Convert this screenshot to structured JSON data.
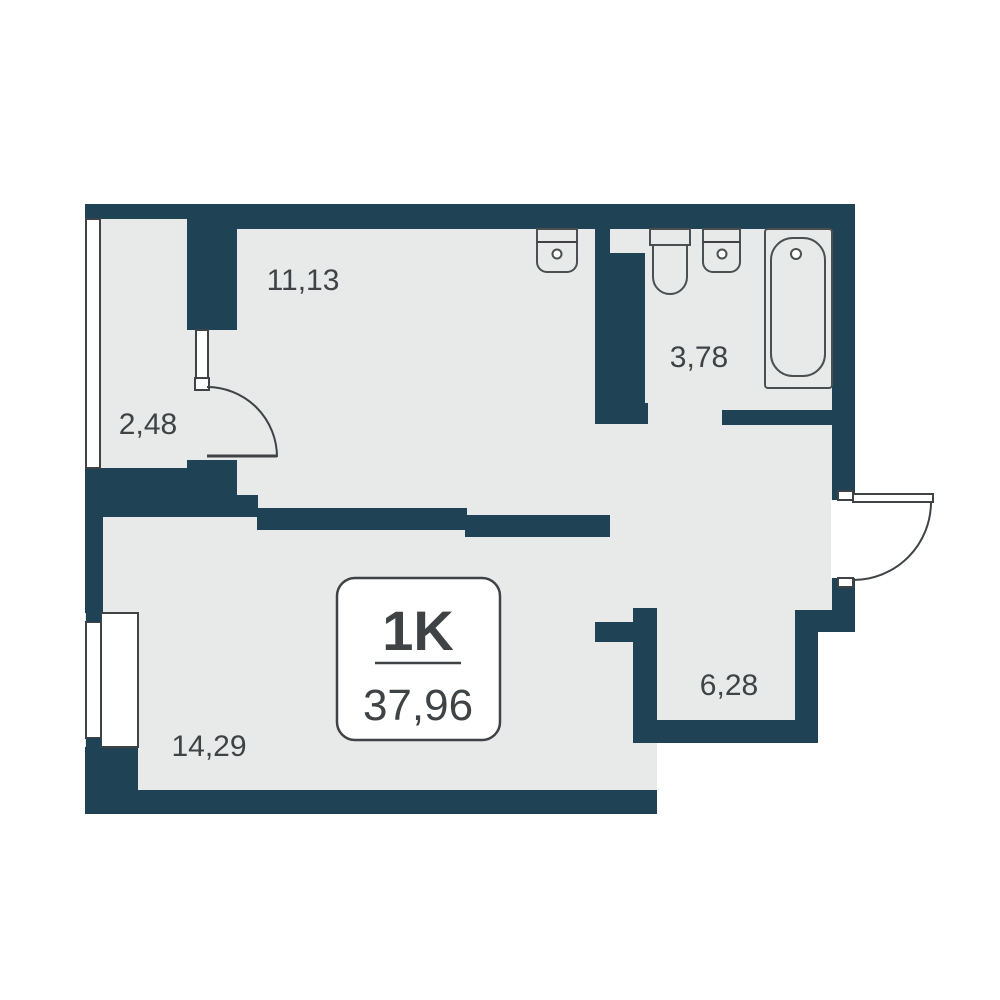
{
  "plan": {
    "unit_type": "1K",
    "total_area": "37,96",
    "rooms": [
      {
        "name": "kitchen-living",
        "area_label": "11,13"
      },
      {
        "name": "balcony",
        "area_label": "2,48"
      },
      {
        "name": "bathroom",
        "area_label": "3,78"
      },
      {
        "name": "hallway",
        "area_label": "6,28"
      },
      {
        "name": "bedroom",
        "area_label": "14,29"
      }
    ]
  },
  "colors": {
    "bg": "#ffffff",
    "wall": "#1f4355",
    "floor": "#e8e9e9",
    "line": "#3f4346",
    "fixline": "#4a4f52",
    "text": "#3f4346"
  }
}
